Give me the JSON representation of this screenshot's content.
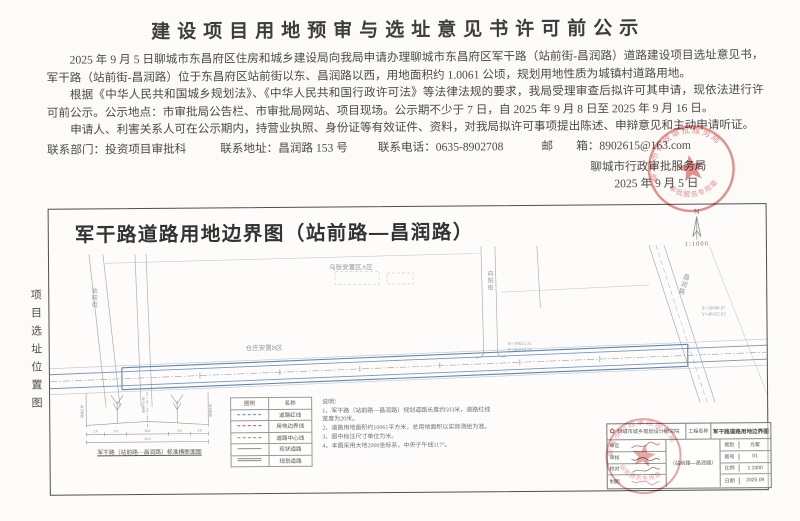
{
  "title": "建设项目用地预审与选址意见书许可前公示",
  "notice": {
    "paragraph1": "2025 年 9 月 5 日聊城市东昌府区住房和城乡建设局向我局申请办理聊城市东昌府区军干路（站前街-昌润路）道路建设项目选址意见书，军干路（站前街-昌润路）位于东昌府区站前街以东、昌润路以西，用地面积约 1.0061 公顷，规划用地性质为城镇村道路用地。",
    "paragraph2": "根据《中华人民共和国城乡规划法》、《中华人民共和国行政许可法》等法律法规的要求，我局受理审查后拟许可其申请，现依法进行许可前公示。公示地点：市审批局公告栏、市审批局网站、项目现场。公示期不少于 7 日，自 2025 年 9 月 8 日至 2025 年 9 月 16 日。",
    "paragraph3": "申请人、利害关系人可在公示期内，持营业执照、身份证等有效证件、资料，对我局拟许可事项提出陈述、申辩意见和主动申请听证。",
    "contact": {
      "department": "联系部门：投资项目审批科",
      "address": "联系地址：昌润路 153 号",
      "phone": "联系电话：0635-8902708",
      "email": "邮　　箱：8902615@163.com"
    },
    "issuer": "聊城市行政审批服务局",
    "issue_date": "2025 年 9 月 5 日"
  },
  "seal": {
    "ring_text": "聊城市行政审批服务局",
    "bottom_text": "审批服务专用章",
    "color": "#d64c4c"
  },
  "map": {
    "side_label": "项目选址位置图",
    "title": "军干路道路用地边界图（站前路—昌润路）",
    "compass_n": "N",
    "scale": "1:1000",
    "labels": {
      "area_a": "乌张安置区A区",
      "area_b": "仓庄安置B区",
      "street_left": "站前街",
      "street_mid": "向阳街",
      "street_right": "昌润路",
      "coord_1_x": "X=39652.31",
      "coord_1_y": "Y=40218.56",
      "coord_2_x": "X=39688.07",
      "coord_2_y": "Y=40452.63"
    }
  },
  "cross_section": {
    "caption": "军干路（站前路—昌润路）标准横断面图",
    "left_label": "道路红线",
    "center_label": "道路中心线",
    "right_label": "道路红线",
    "d1": "2.0",
    "d2": "3.0",
    "d3": "10.0",
    "d4": "3.0",
    "d5": "2.0",
    "total": "20.0"
  },
  "legend": {
    "header_symbol": "图例",
    "header_name": "名称",
    "rows": [
      {
        "name": "道路红线"
      },
      {
        "name": "用地边界线"
      },
      {
        "name": "道路中心线"
      },
      {
        "name": "现状道路"
      },
      {
        "name": "规划道路"
      }
    ]
  },
  "notes": {
    "heading": "说明：",
    "items": [
      "1、军干路（站前路—昌润路）规划道路长度约503米，道路红线宽度为20米。",
      "2、道路用地面积约10061平方米，总用地面积以实际测绘为准。",
      "3、图中标注尺寸单位为米。",
      "4、本图采用大地2000坐标系，中央子午线117°。"
    ]
  },
  "titleblock": {
    "org": "聊城市城乡规划设计研究院",
    "project_label": "工程名称",
    "project_name": "军干路道路用地边界图",
    "project_sub": "（站前路—昌润路）",
    "rows_left": [
      "审定",
      "审核",
      "校对",
      "制图"
    ],
    "rows_right": [
      {
        "label": "图别",
        "value": "方案"
      },
      {
        "label": "图号",
        "value": "01"
      },
      {
        "label": "比例",
        "value": "1:1000"
      },
      {
        "label": "日期",
        "value": "2025.09"
      }
    ]
  }
}
